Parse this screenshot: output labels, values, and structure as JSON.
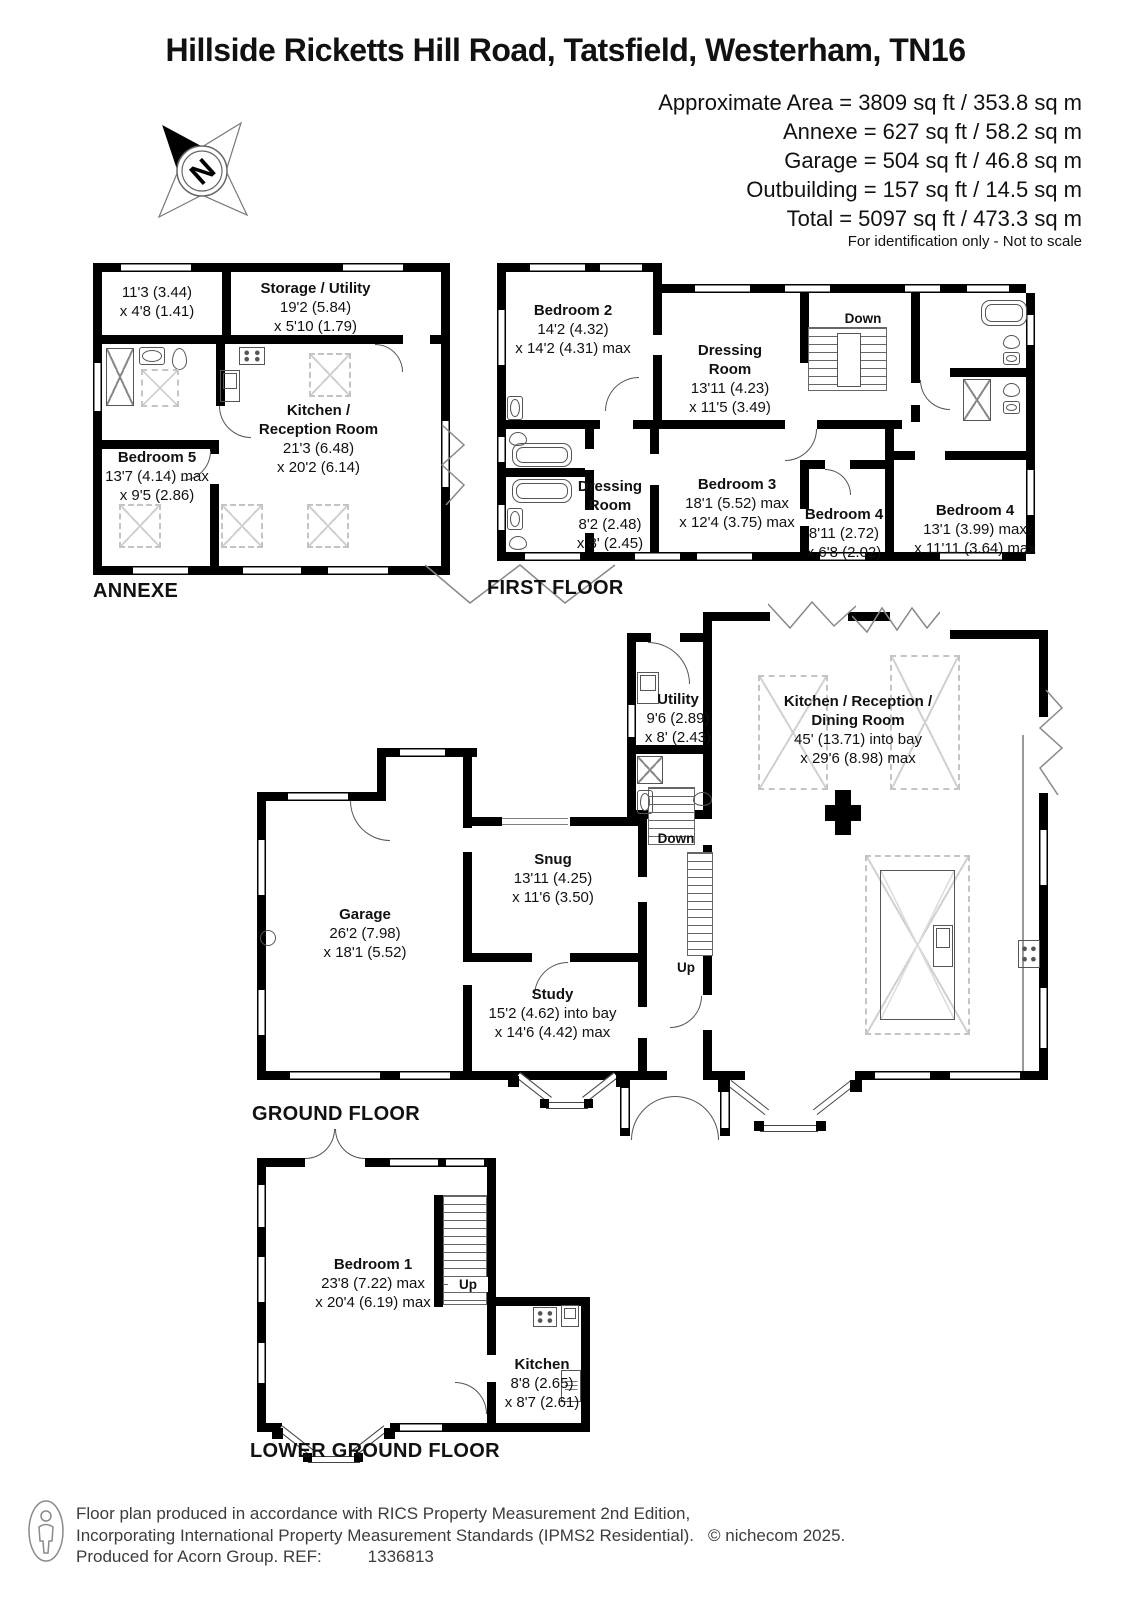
{
  "header": {
    "title": "Hillside Ricketts Hill Road, Tatsfield, Westerham, TN16",
    "area_lines": [
      "Approximate Area = 3809 sq ft / 353.8 sq m",
      "Annexe = 627 sq ft / 58.2 sq m",
      "Garage = 504 sq ft / 46.8 sq m",
      "Outbuilding = 157 sq ft / 14.5 sq m",
      "Total = 5097 sq ft / 473.3 sq m"
    ],
    "note": "For identification only - Not to scale",
    "compass_n": "N"
  },
  "floors": {
    "annexe": {
      "label": "ANNEXE",
      "rooms": {
        "hall": {
          "size": "11'3 (3.44)\nx 4'8 (1.41)"
        },
        "storage_utility": {
          "name": "Storage / Utility",
          "size": "19'2 (5.84)\nx 5'10 (1.79)"
        },
        "kitchen_reception": {
          "name": "Kitchen /\nReception Room",
          "size": "21'3 (6.48)\nx 20'2 (6.14)"
        },
        "bedroom5": {
          "name": "Bedroom 5",
          "size": "13'7 (4.14) max\nx 9'5 (2.86)"
        }
      }
    },
    "first": {
      "label": "FIRST FLOOR",
      "stairs_down": "Down",
      "rooms": {
        "bedroom2": {
          "name": "Bedroom 2",
          "size": "14'2 (4.32)\nx 14'2 (4.31) max"
        },
        "dressing1": {
          "name": "Dressing\nRoom",
          "size": "13'11 (4.23)\nx 11'5 (3.49)"
        },
        "dressing2": {
          "name": "Dressing\nRoom",
          "size": "8'2 (2.48)\nx 8' (2.45)"
        },
        "bedroom3": {
          "name": "Bedroom 3",
          "size": "18'1 (5.52) max\nx 12'4 (3.75) max"
        },
        "bedroom4a": {
          "name": "Bedroom 4",
          "size": "8'11 (2.72)\nx 6'8 (2.02)"
        },
        "bedroom4b": {
          "name": "Bedroom 4",
          "size": "13'1 (3.99) max\nx 11'11 (3.64) max"
        }
      }
    },
    "ground": {
      "label": "GROUND FLOOR",
      "stairs_down": "Down",
      "stairs_up": "Up",
      "rooms": {
        "utility": {
          "name": "Utility",
          "size": "9'6 (2.89)\nx 8' (2.43)"
        },
        "kitchen_reception_dining": {
          "name": "Kitchen / Reception /\nDining Room",
          "size": "45' (13.71) into bay\nx 29'6 (8.98) max"
        },
        "snug": {
          "name": "Snug",
          "size": "13'11 (4.25)\nx 11'6 (3.50)"
        },
        "garage": {
          "name": "Garage",
          "size": "26'2 (7.98)\nx 18'1 (5.52)"
        },
        "study": {
          "name": "Study",
          "size": "15'2 (4.62) into bay\nx 14'6 (4.42) max"
        }
      }
    },
    "lower": {
      "label": "LOWER GROUND FLOOR",
      "stairs_up": "Up",
      "rooms": {
        "bedroom1": {
          "name": "Bedroom 1",
          "size": "23'8 (7.22) max\nx 20'4 (6.19) max"
        },
        "kitchen": {
          "name": "Kitchen",
          "size": "8'8 (2.65)\nx 8'7 (2.61)"
        }
      }
    }
  },
  "footer": {
    "line1": "Floor plan produced in accordance with RICS Property Measurement 2nd Edition,",
    "line2": "Incorporating International Property Measurement Standards (IPMS2 Residential).",
    "copyright": "© nichecom 2025.",
    "line3": "Produced for Acorn Group.   REF:",
    "ref": "1336813"
  }
}
